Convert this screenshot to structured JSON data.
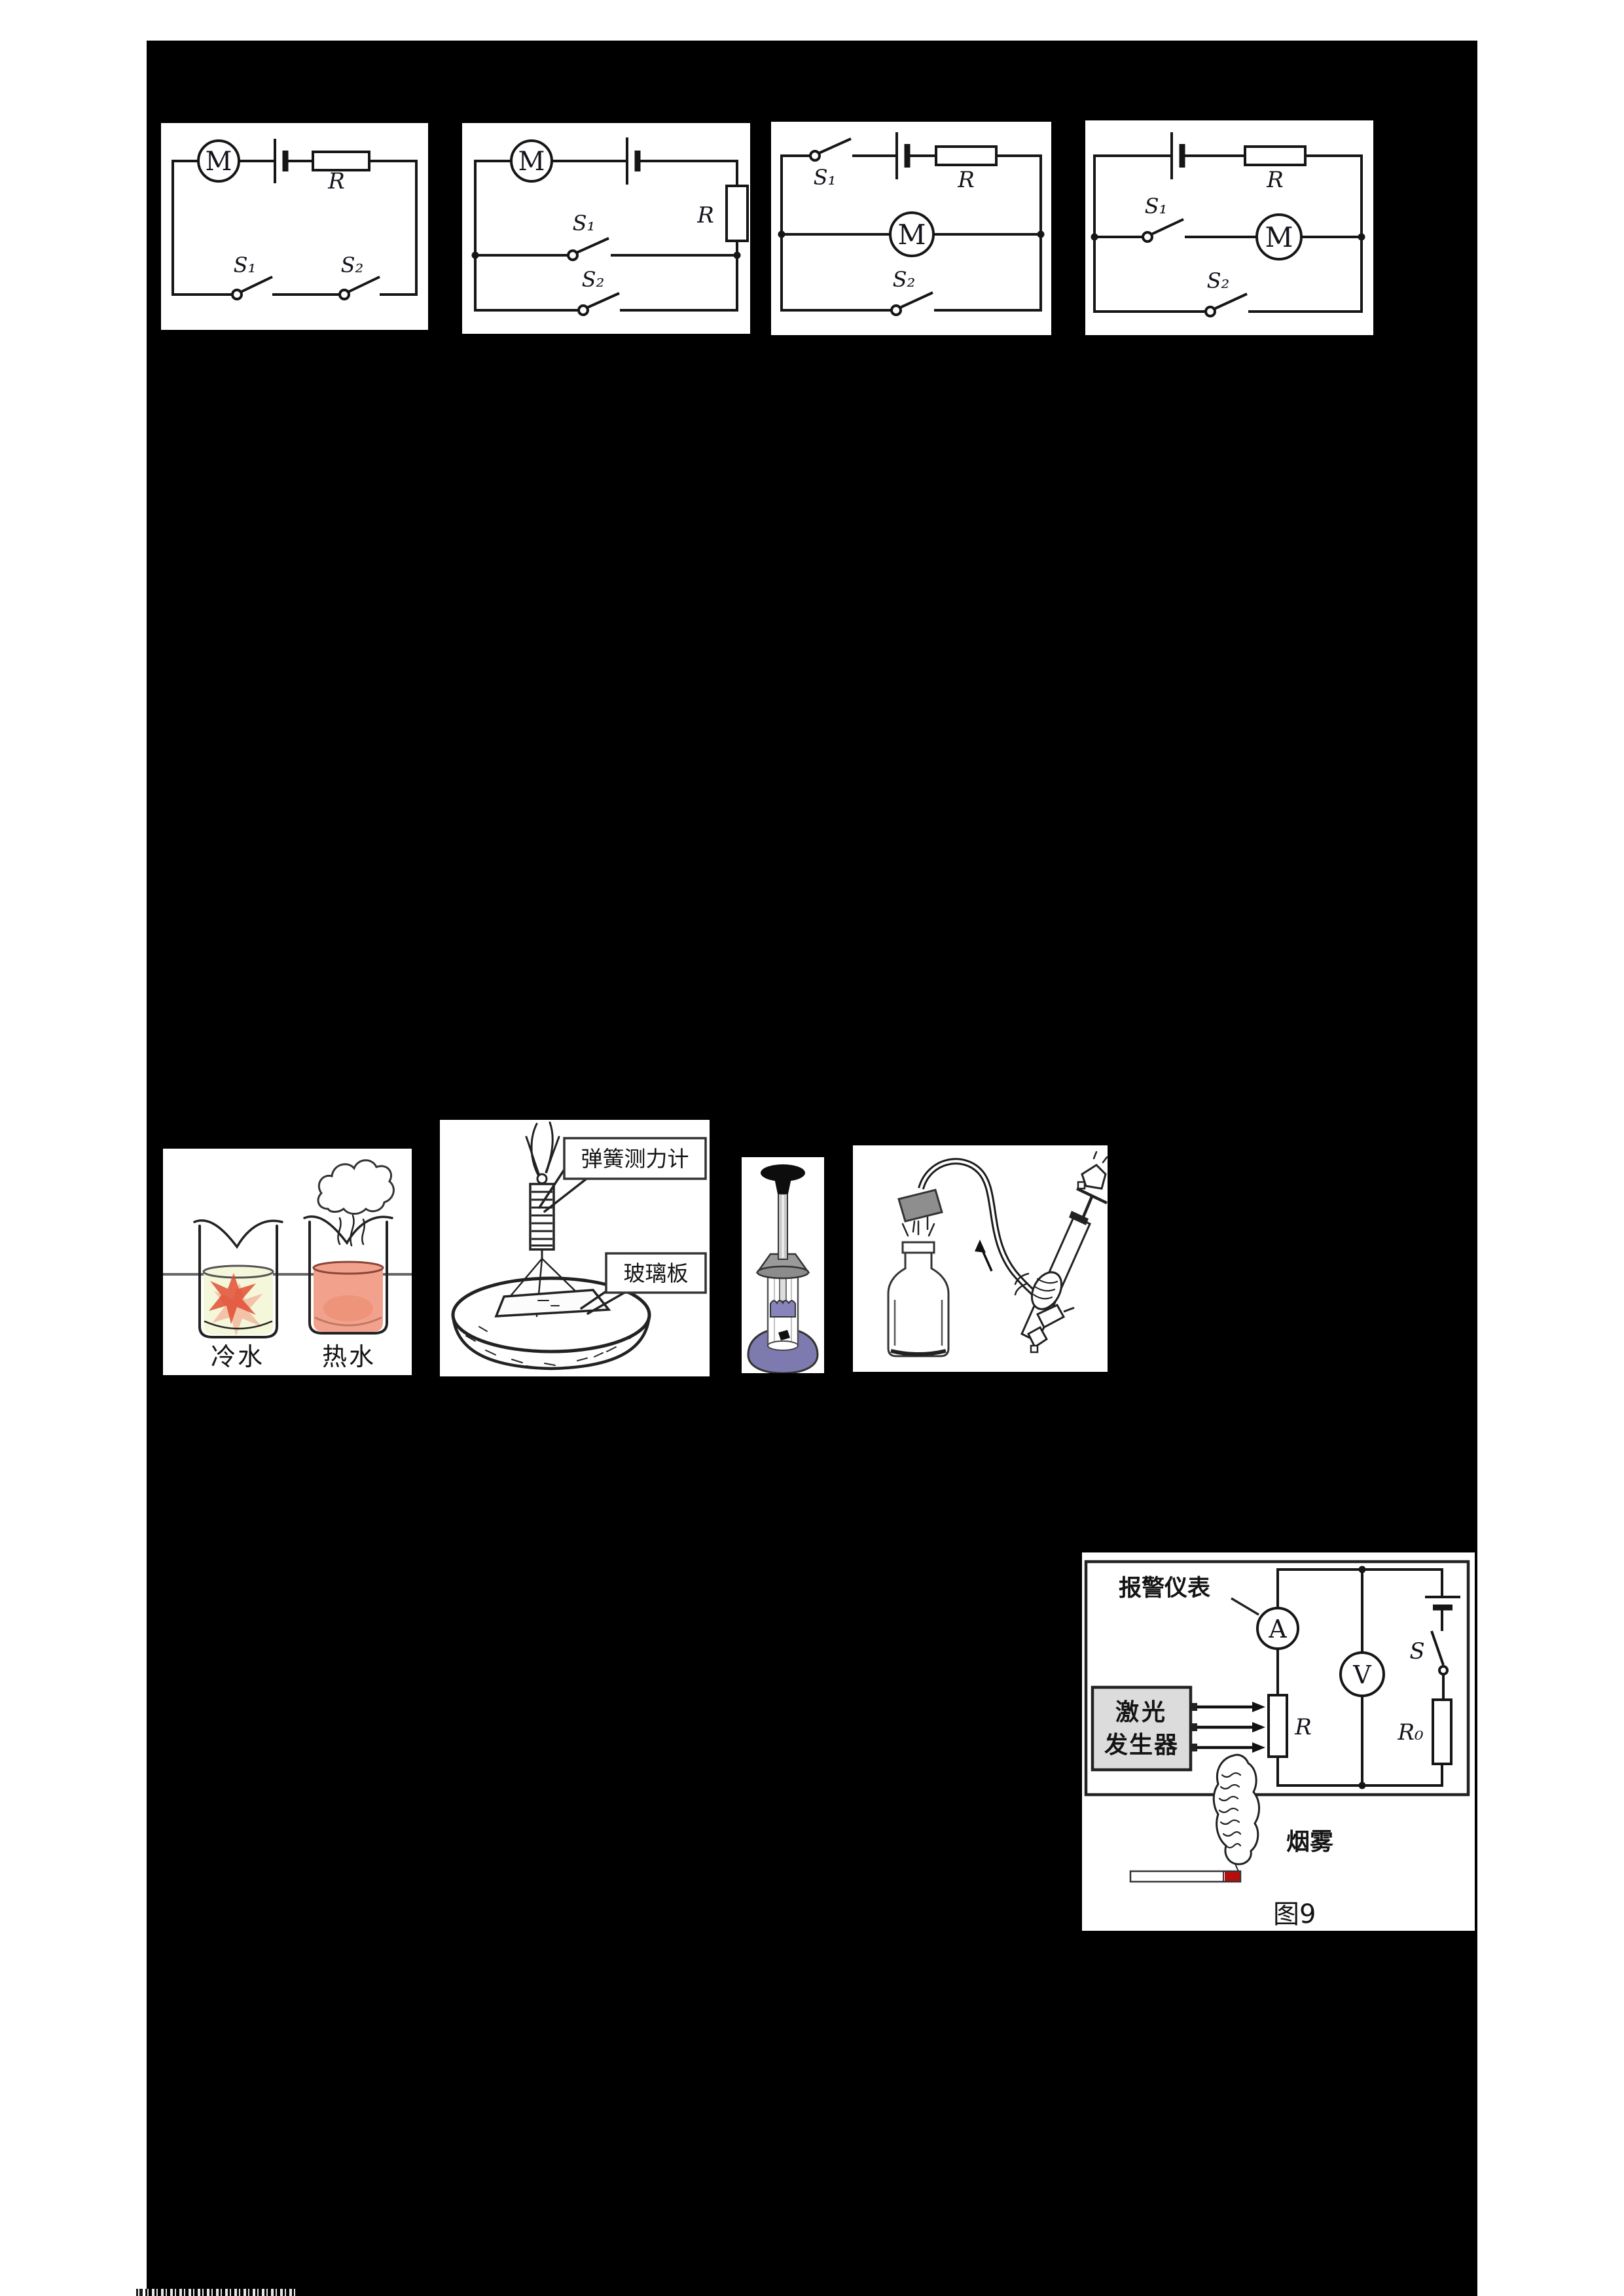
{
  "colors": {
    "page_background": "#ffffff",
    "board_background": "#000000",
    "cold_water": "#f4f7d9",
    "hot_water": "#f2a28c",
    "ink_drop": "#e0482e",
    "syringe_base_purple": "#7d7ab0",
    "laser_box_gray": "#dcdcdc",
    "cigarette_tip_red": "#b40f0f"
  },
  "circuit_labels": {
    "motor": "M",
    "resistor": "R",
    "switch1": "S₁",
    "switch2": "S₂"
  },
  "diffusion_fig": {
    "cold_label": "冷水",
    "hot_label": "热水"
  },
  "buoyancy_fig": {
    "spring_scale_label": "弹簧测力计",
    "glass_plate_label": "玻璃板"
  },
  "smoke_alarm_fig": {
    "alarm_meter_label": "报警仪表",
    "laser_label_line1": "激光",
    "laser_label_line2": "发生器",
    "ammeter_label": "A",
    "voltmeter_label": "V",
    "switch_label": "S",
    "photoresistor_label": "R",
    "series_resistor_label": "R₀",
    "smoke_label": "烟雾",
    "caption": "图9"
  }
}
